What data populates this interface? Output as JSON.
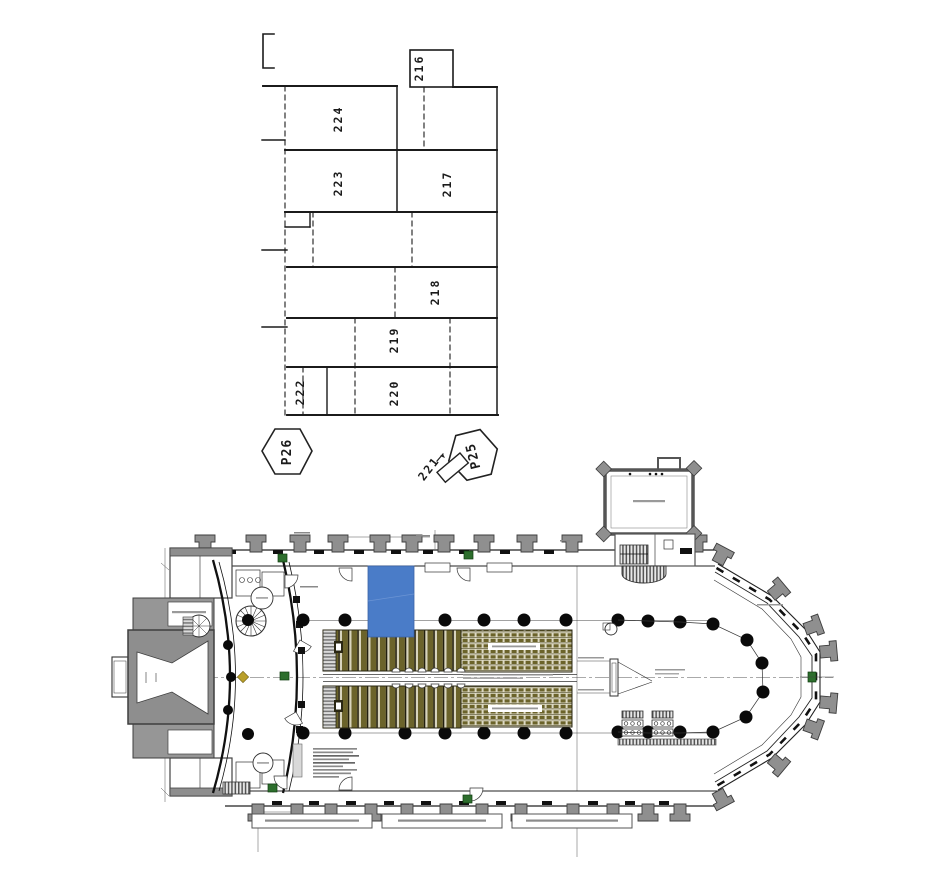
{
  "document": {
    "type": "architectural-plan-sheet",
    "upper_drawing": "cadastral parcel sketch",
    "lower_drawing": "church floor plan with highlighted zone"
  },
  "colors": {
    "highlight_blue": "#4a7cc8",
    "highlight_blue_edge": "#3a63a6",
    "wall_gray": "#8f8f8f",
    "pew_olive": "#6b632a",
    "pew_light": "#d7d3bc",
    "door_green": "#2d6e2d",
    "line_black": "#1b1b1b"
  },
  "parcel_map": {
    "labels": {
      "p216": "216",
      "p217": "217",
      "p218": "218",
      "p219": "219",
      "p220": "220",
      "p221": "221",
      "p222": "222",
      "p223": "223",
      "p224": "224"
    },
    "markers": {
      "p26": "P26",
      "p25": "P25"
    }
  }
}
